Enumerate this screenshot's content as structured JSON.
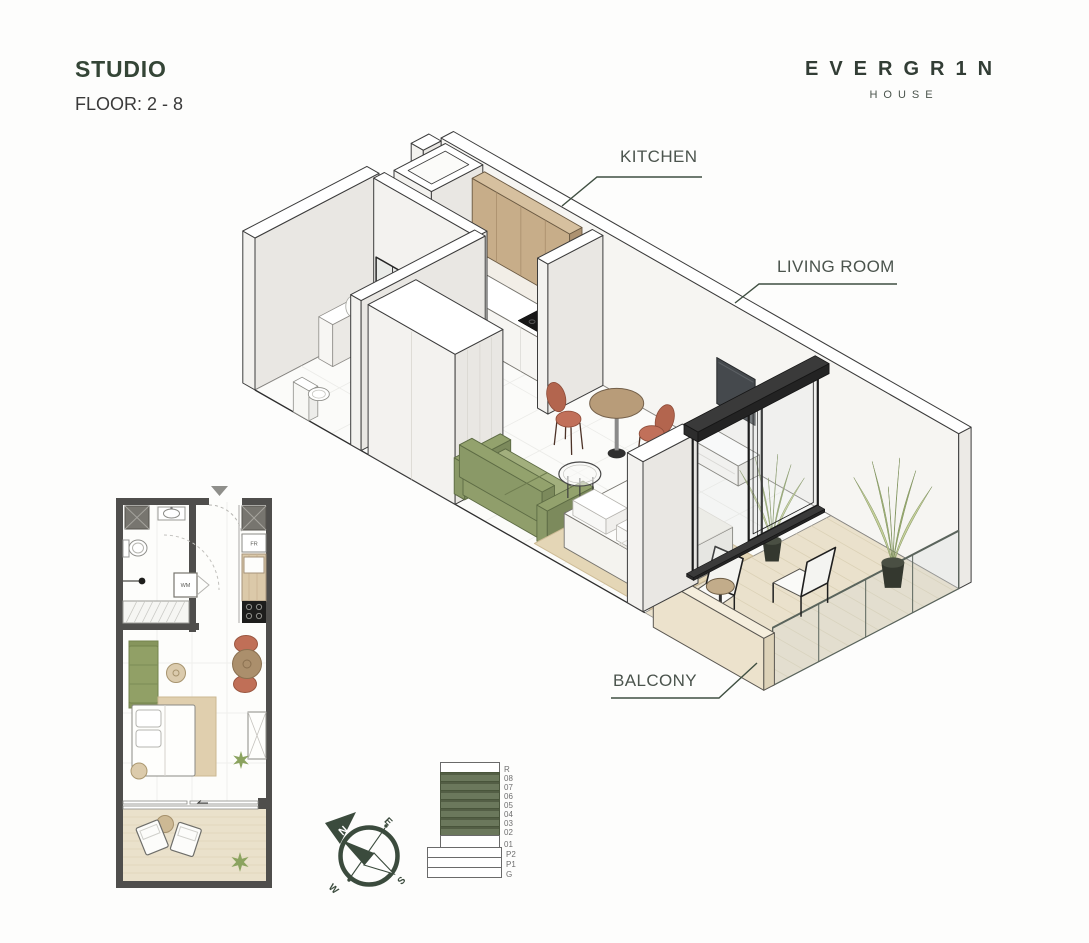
{
  "header": {
    "title": "STUDIO",
    "floor_range": "FLOOR: 2 - 8"
  },
  "brand": {
    "name": "EVERGR1N",
    "subtitle": "HOUSE"
  },
  "iso_labels": {
    "kitchen": "KITCHEN",
    "living_room": "LIVING ROOM",
    "balcony": "BALCONY"
  },
  "floor_plan": {
    "fridge_label": "FR",
    "washer_label": "WM"
  },
  "building_stack": {
    "tower": [
      {
        "label": "R",
        "highlighted": false
      },
      {
        "label": "08",
        "highlighted": true
      },
      {
        "label": "07",
        "highlighted": true
      },
      {
        "label": "06",
        "highlighted": true
      },
      {
        "label": "05",
        "highlighted": true
      },
      {
        "label": "04",
        "highlighted": true
      },
      {
        "label": "03",
        "highlighted": true
      },
      {
        "label": "02",
        "highlighted": true
      },
      {
        "label": "01",
        "highlighted": false
      }
    ],
    "podium": [
      {
        "label": "P2"
      },
      {
        "label": "P1"
      },
      {
        "label": "G"
      }
    ]
  },
  "compass": {
    "n": "N",
    "e": "E",
    "s": "S",
    "w": "W"
  },
  "colors": {
    "accent_green": "#3b4b3d",
    "highlight_floor": "#6b785c",
    "title_green": "#344536"
  }
}
